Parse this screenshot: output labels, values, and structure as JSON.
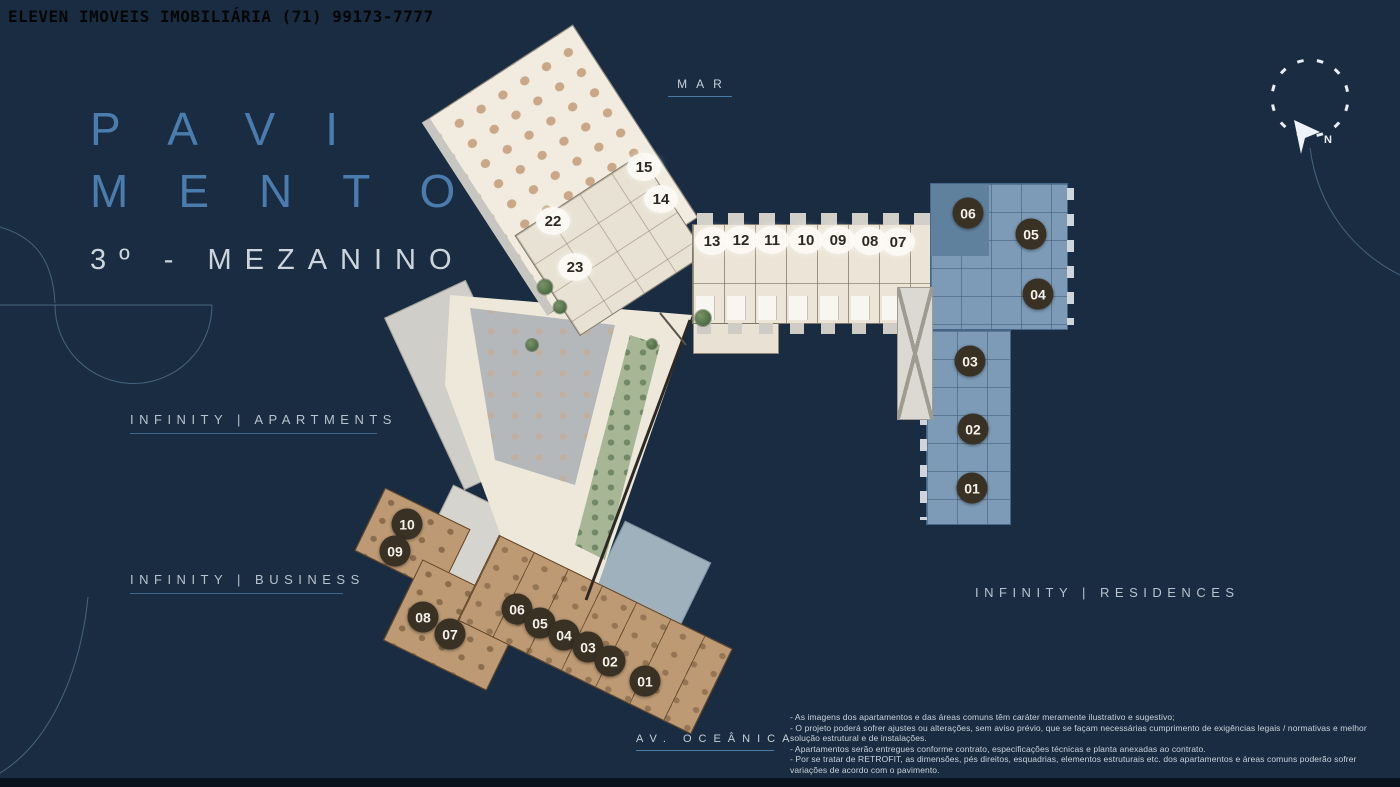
{
  "watermark": "ELEVEN IMOVEIS IMOBILIÁRIA (71) 99173-7777",
  "title": {
    "line1": "PAVI",
    "line2": "MENTO",
    "subtitle": "3º - MEZANINO"
  },
  "labels": {
    "mar": "MAR",
    "apartments": "INFINITY | APARTMENTS",
    "business": "INFINITY | BUSINESS",
    "residences": "INFINITY | RESIDENCES",
    "avenue": "AV. OCEÂNICA",
    "compass_n": "N"
  },
  "disclaimer": {
    "lines": [
      "- As imagens dos apartamentos e das áreas comuns têm caráter meramente ilustrativo e sugestivo;",
      "- O projeto poderá sofrer ajustes ou alterações, sem aviso prévio, que se façam necessárias cumprimento de exigências legais / normativas e melhor solução estrutural e de instalações.",
      "- Apartamentos serão entregues conforme contrato, especificações técnicas e planta anexadas ao contrato.",
      "- Por se tratar de RETROFIT, as dimensões, pés direitos, esquadrias, elementos estruturais etc. dos apartamentos e áreas comuns poderão sofrer variações de acordo com o pavimento."
    ]
  },
  "units": {
    "apartments": {
      "style": "light",
      "items": [
        {
          "label": "15",
          "x": 644,
          "y": 167
        },
        {
          "label": "14",
          "x": 661,
          "y": 199
        },
        {
          "label": "22",
          "x": 553,
          "y": 221
        },
        {
          "label": "23",
          "x": 575,
          "y": 267
        },
        {
          "label": "13",
          "x": 712,
          "y": 241
        },
        {
          "label": "12",
          "x": 741,
          "y": 240
        },
        {
          "label": "11",
          "x": 772,
          "y": 240
        },
        {
          "label": "10",
          "x": 806,
          "y": 240
        },
        {
          "label": "09",
          "x": 838,
          "y": 240
        },
        {
          "label": "08",
          "x": 870,
          "y": 241
        },
        {
          "label": "07",
          "x": 898,
          "y": 242
        }
      ]
    },
    "residences": {
      "style": "dark",
      "items": [
        {
          "label": "06",
          "x": 968,
          "y": 213
        },
        {
          "label": "05",
          "x": 1031,
          "y": 234
        },
        {
          "label": "04",
          "x": 1038,
          "y": 294
        },
        {
          "label": "03",
          "x": 970,
          "y": 361
        },
        {
          "label": "02",
          "x": 973,
          "y": 429
        },
        {
          "label": "01",
          "x": 972,
          "y": 488
        }
      ]
    },
    "business": {
      "style": "dark",
      "items": [
        {
          "label": "10",
          "x": 407,
          "y": 524
        },
        {
          "label": "09",
          "x": 395,
          "y": 551
        },
        {
          "label": "08",
          "x": 423,
          "y": 617
        },
        {
          "label": "07",
          "x": 450,
          "y": 634
        },
        {
          "label": "06",
          "x": 517,
          "y": 609
        },
        {
          "label": "05",
          "x": 540,
          "y": 623
        },
        {
          "label": "04",
          "x": 564,
          "y": 635
        },
        {
          "label": "03",
          "x": 588,
          "y": 647
        },
        {
          "label": "02",
          "x": 610,
          "y": 661
        },
        {
          "label": "01",
          "x": 645,
          "y": 681
        }
      ]
    }
  },
  "colors": {
    "background": "#1a2c41",
    "title_blue": "#4b7cae",
    "label_text": "#b7c3ce",
    "underline_blue": "#40658c",
    "cream_building": "#efe9dc",
    "tan_building": "#bd9a74",
    "blue_building": "#7d9bb6",
    "badge_dark": "#3a3125",
    "badge_light": "#fcfaf4"
  }
}
